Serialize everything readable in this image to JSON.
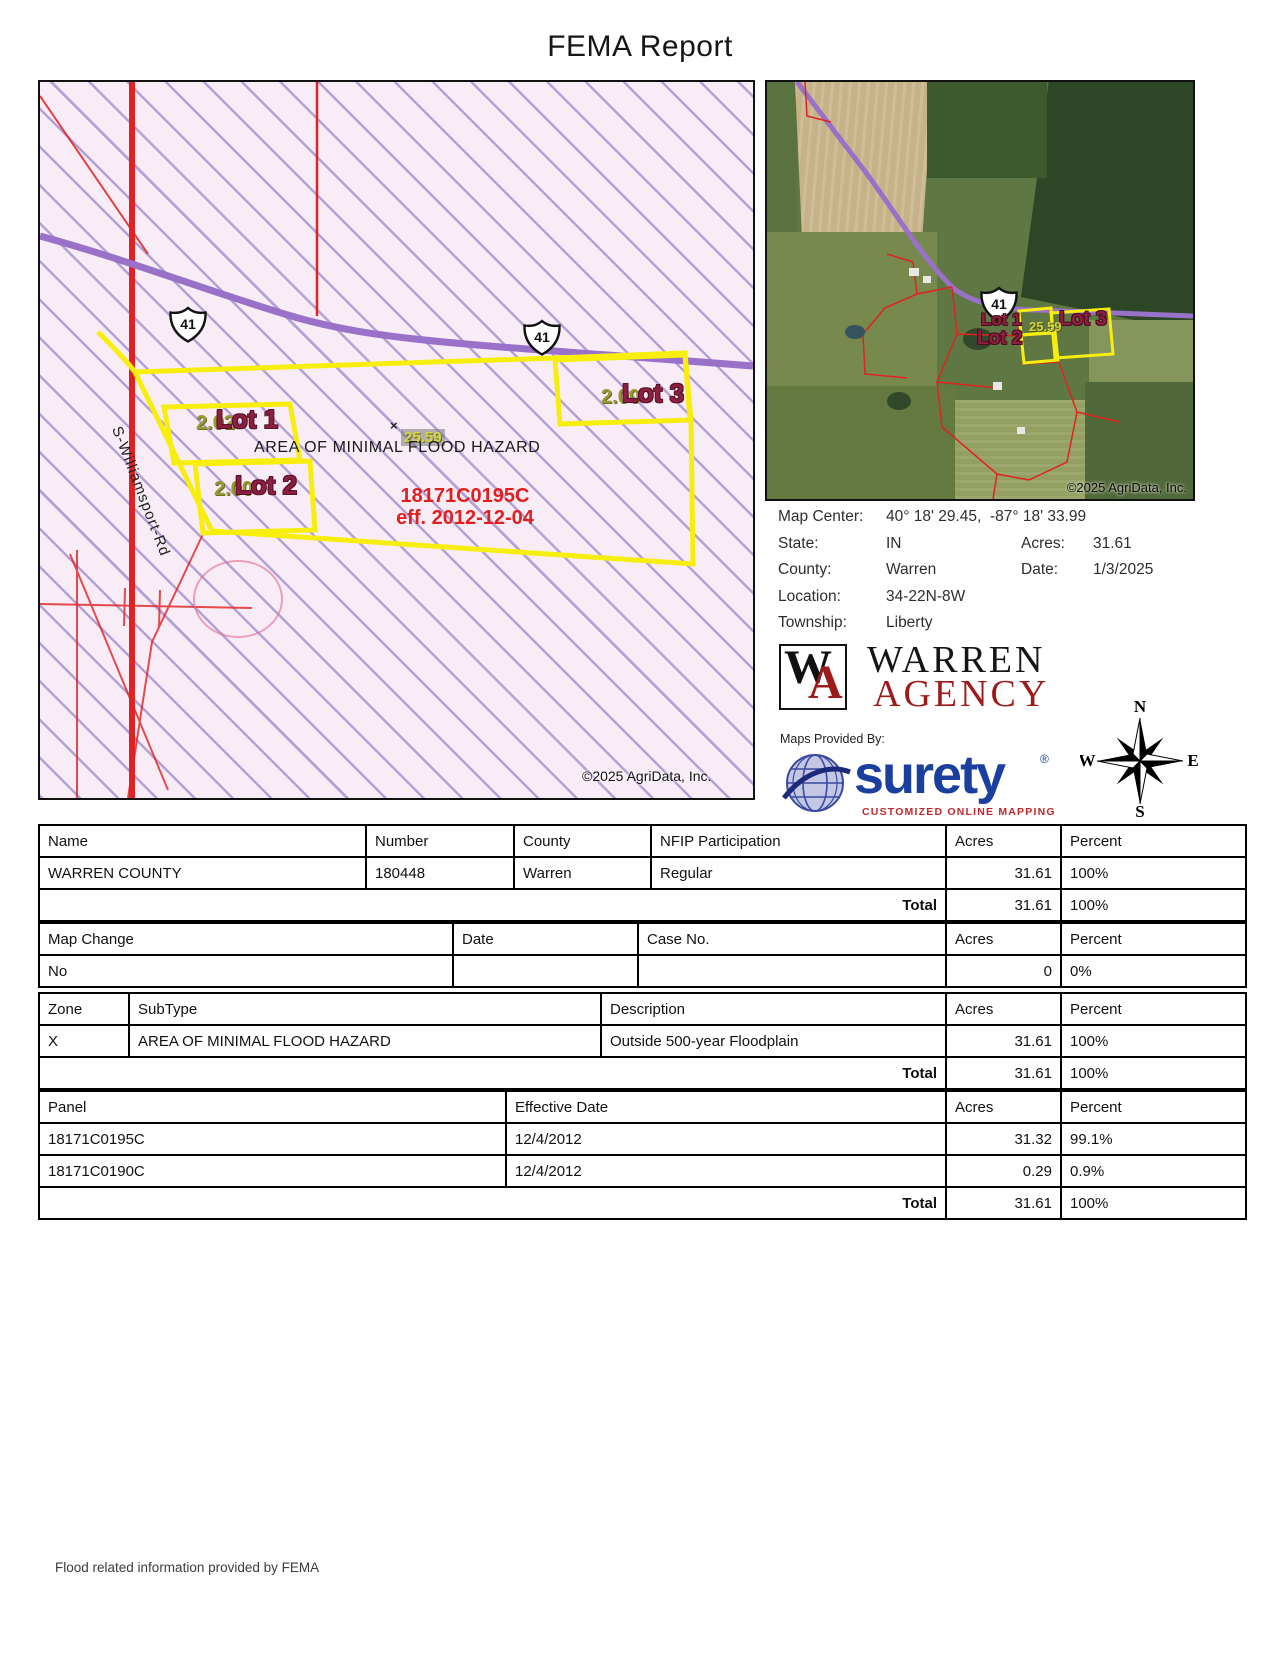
{
  "title": "FEMA Report",
  "footer": "Flood related information provided by FEMA",
  "flood_map": {
    "highway_shield": "41",
    "road_label": "S-Williamsport-Rd",
    "area_label": "AREA OF MINIMAL FLOOD HAZARD",
    "center_acres": "25.59",
    "x_mark": "×",
    "panel_number": "18171C0195C",
    "panel_effective": "eff. 2012-12-04",
    "copyright": "©2025 AgriData, Inc.",
    "lots": [
      {
        "name": "Lot 1",
        "acres": "2.02"
      },
      {
        "name": "Lot 2",
        "acres": "2.00"
      },
      {
        "name": "Lot 3",
        "acres": "2.00"
      }
    ],
    "colors": {
      "hatch": "#7a63be",
      "boundary": "#f8ee0e",
      "highway": "#9a71c8",
      "road": "#e02222",
      "panel_text": "#e21f1f"
    }
  },
  "aerial_map": {
    "highway_shield": "41",
    "center_acres": "25.59",
    "copyright": "©2025 AgriData, Inc.",
    "lots": [
      {
        "name": "Lot 1"
      },
      {
        "name": "Lot 2"
      },
      {
        "name": "Lot 3"
      }
    ]
  },
  "info": {
    "map_center_label": "Map Center:",
    "map_center": "40° 18' 29.45,  -87° 18' 33.99",
    "state_label": "State:",
    "state": "IN",
    "acres_label": "Acres:",
    "acres": "31.61",
    "county_label": "County:",
    "county": "Warren",
    "date_label": "Date:",
    "date": "1/3/2025",
    "location_label": "Location:",
    "location": "34-22N-8W",
    "township_label": "Township:",
    "township": "Liberty"
  },
  "branding": {
    "wa_w": "W",
    "wa_a": "A",
    "name_top": "WARREN",
    "name_bottom": "AGENCY",
    "maps_provided_by": "Maps Provided By:",
    "surety_wordmark": "surety",
    "surety_reg": "®",
    "surety_tagline": "CUSTOMIZED ONLINE MAPPING",
    "agridata_copyright": "© AgriData, Inc. 2023",
    "agridata_url": "www.AgriDataInc.com",
    "compass": {
      "n": "N",
      "e": "E",
      "s": "S",
      "w": "W"
    }
  },
  "nfip_table": {
    "headers": [
      "Name",
      "Number",
      "County",
      "NFIP Participation",
      "Acres",
      "Percent"
    ],
    "rows": [
      [
        "WARREN COUNTY",
        "180448",
        "Warren",
        "Regular",
        "31.61",
        "100%"
      ]
    ],
    "total_label": "Total",
    "total_acres": "31.61",
    "total_percent": "100%"
  },
  "map_change_table": {
    "headers": [
      "Map Change",
      "Date",
      "Case No.",
      "Acres",
      "Percent"
    ],
    "rows": [
      [
        "No",
        "",
        "",
        "0",
        "0%"
      ]
    ]
  },
  "zone_table": {
    "headers": [
      "Zone",
      "SubType",
      "Description",
      "Acres",
      "Percent"
    ],
    "rows": [
      [
        "X",
        "AREA OF MINIMAL FLOOD HAZARD",
        "Outside 500-year Floodplain",
        "31.61",
        "100%"
      ]
    ],
    "total_label": "Total",
    "total_acres": "31.61",
    "total_percent": "100%"
  },
  "panel_table": {
    "headers": [
      "Panel",
      "Effective Date",
      "Acres",
      "Percent"
    ],
    "rows": [
      [
        "18171C0195C",
        "12/4/2012",
        "31.32",
        "99.1%"
      ],
      [
        "18171C0190C",
        "12/4/2012",
        "0.29",
        "0.9%"
      ]
    ],
    "total_label": "Total",
    "total_acres": "31.61",
    "total_percent": "100%"
  }
}
